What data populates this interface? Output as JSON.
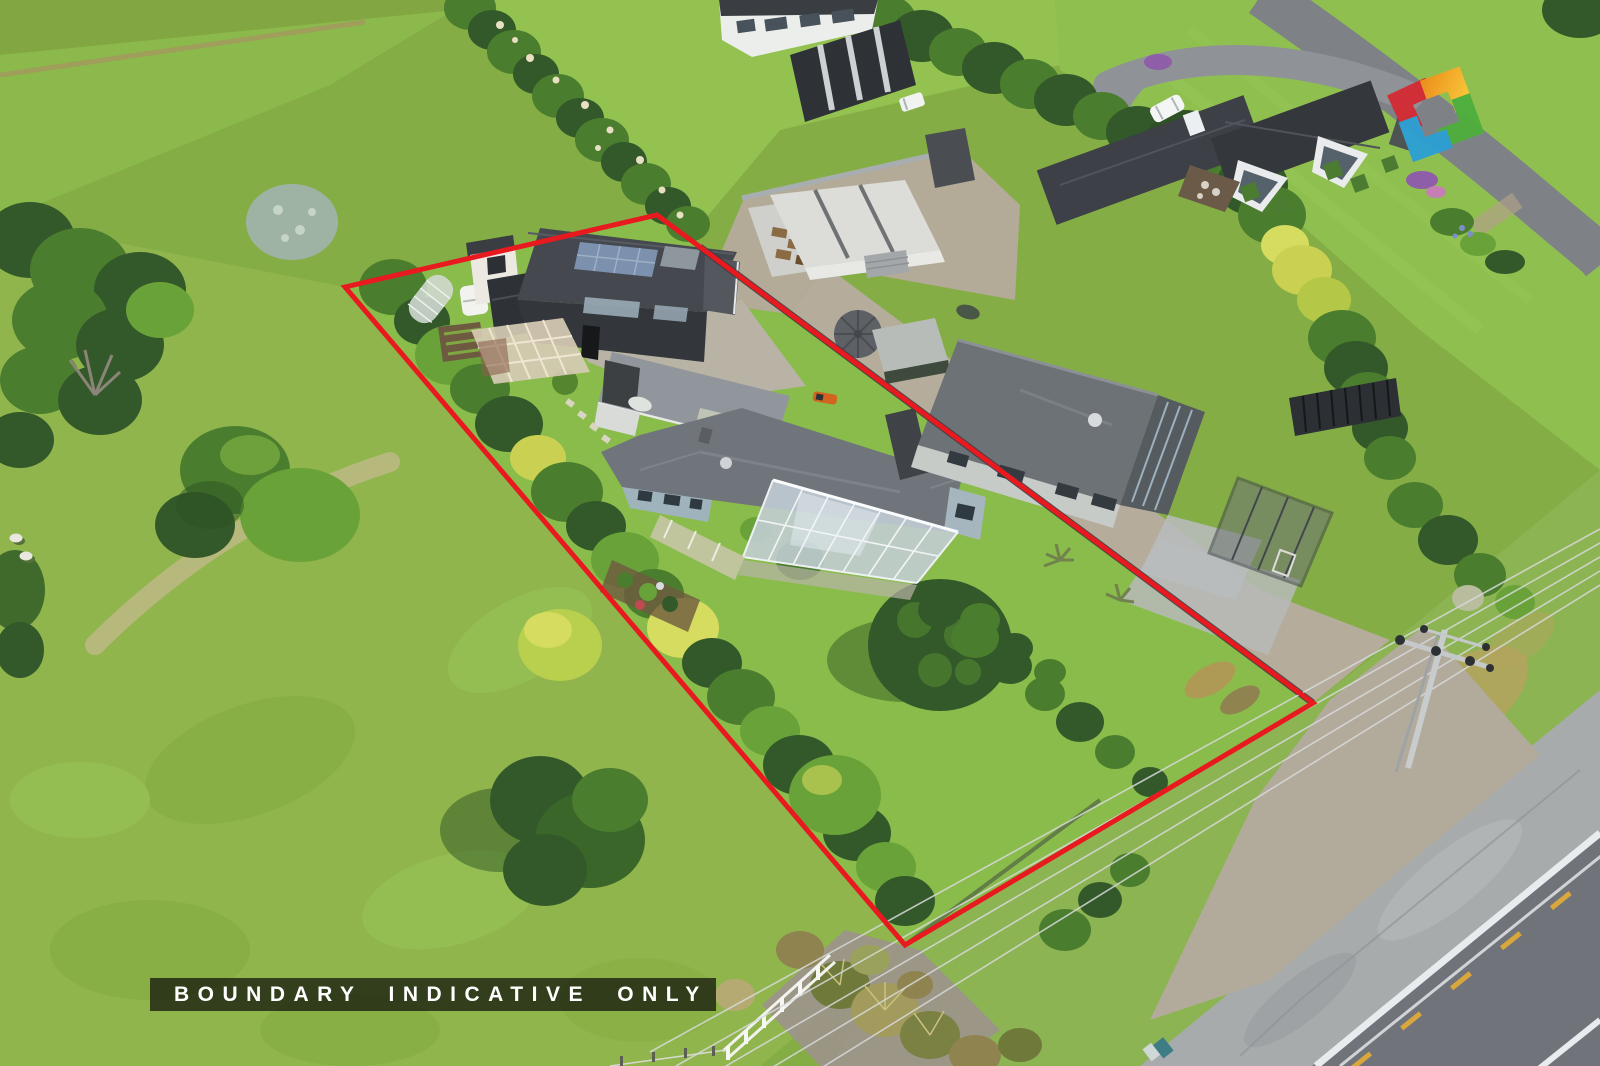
{
  "caption": {
    "text": "BOUNDARY INDICATIVE ONLY",
    "text_color": "#ffffff",
    "bar_color": "rgba(24,28,14,0.78)"
  },
  "boundary": {
    "points": "345,287 657,215 1313,703 905,945",
    "color": "#e8191f",
    "width": "5"
  },
  "logo": {
    "name": "real-estate-star-logo",
    "colors": {
      "red": "#d42b33",
      "orange": "#ef8c1a",
      "yellow": "#ffd23f",
      "green": "#4fae3d",
      "blue": "#2c9fd4",
      "dark": "#4b5055"
    }
  },
  "palette": {
    "grass_base": "#84ae45",
    "grass_bright": "#93c251",
    "pasture": "#90b54d",
    "hedge_dark": "#33592a",
    "hedge_mid": "#4b7d2e",
    "hedge_light": "#69a238",
    "hedge_yellow": "#c9d052",
    "roof_charcoal": "#3f434a",
    "roof_gray": "#6d7277",
    "glass": "#c3ced6",
    "gravel": "#b5ac9b",
    "road_asphalt": "#70747a",
    "road_marking_white": "#e9ecee",
    "road_marking_yellow": "#d9a73c",
    "boundary_red": "#e8191f"
  }
}
